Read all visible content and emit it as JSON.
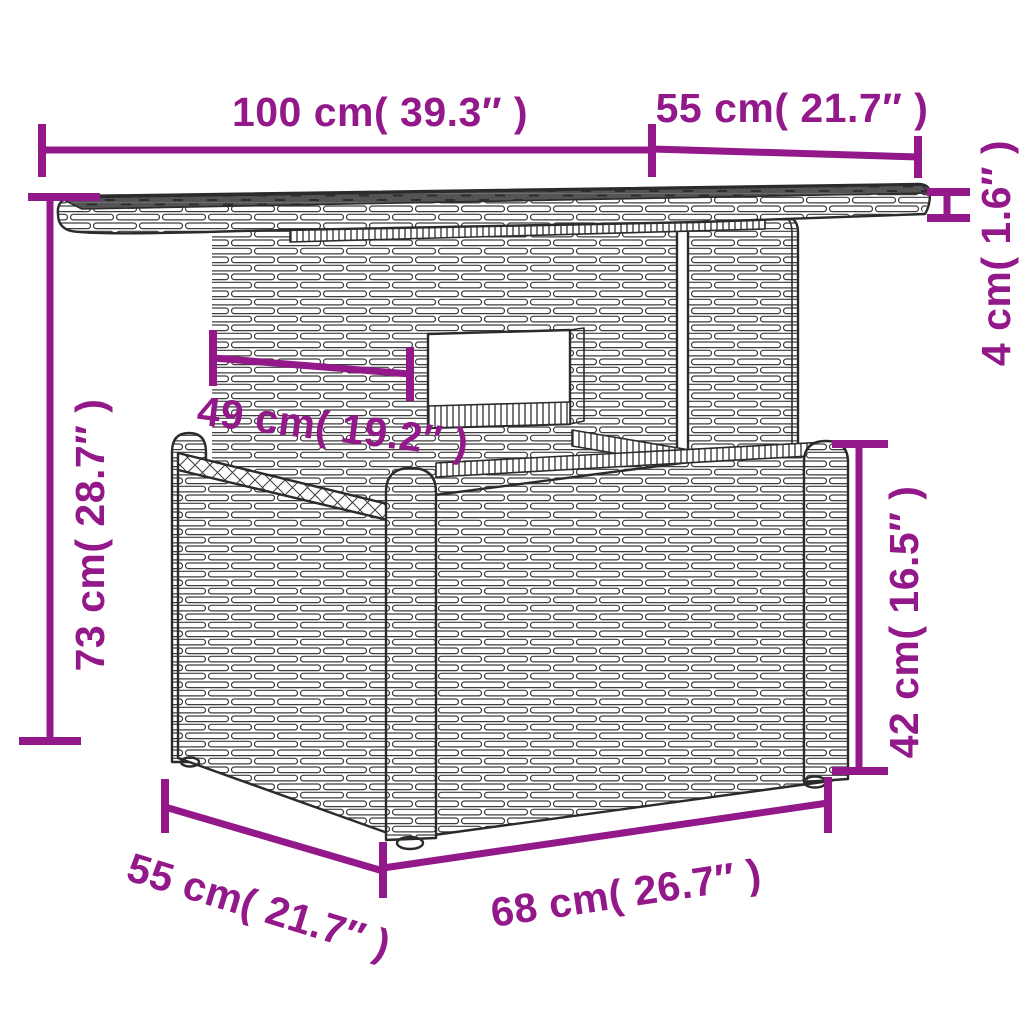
{
  "diagram": {
    "accent_color": "#93188A",
    "dims": {
      "top_width": "100 cm( 39.3″ )",
      "top_depth": "55 cm( 21.7″ )",
      "top_thickness": "4 cm( 1.6″ )",
      "total_height": "73 cm( 28.7″ )",
      "pedestal_width": "49 cm( 19.2″ )",
      "base_height": "42 cm( 16.5″ )",
      "base_width": "68 cm( 26.7″ )",
      "base_depth": "55 cm( 21.7″ )"
    }
  }
}
